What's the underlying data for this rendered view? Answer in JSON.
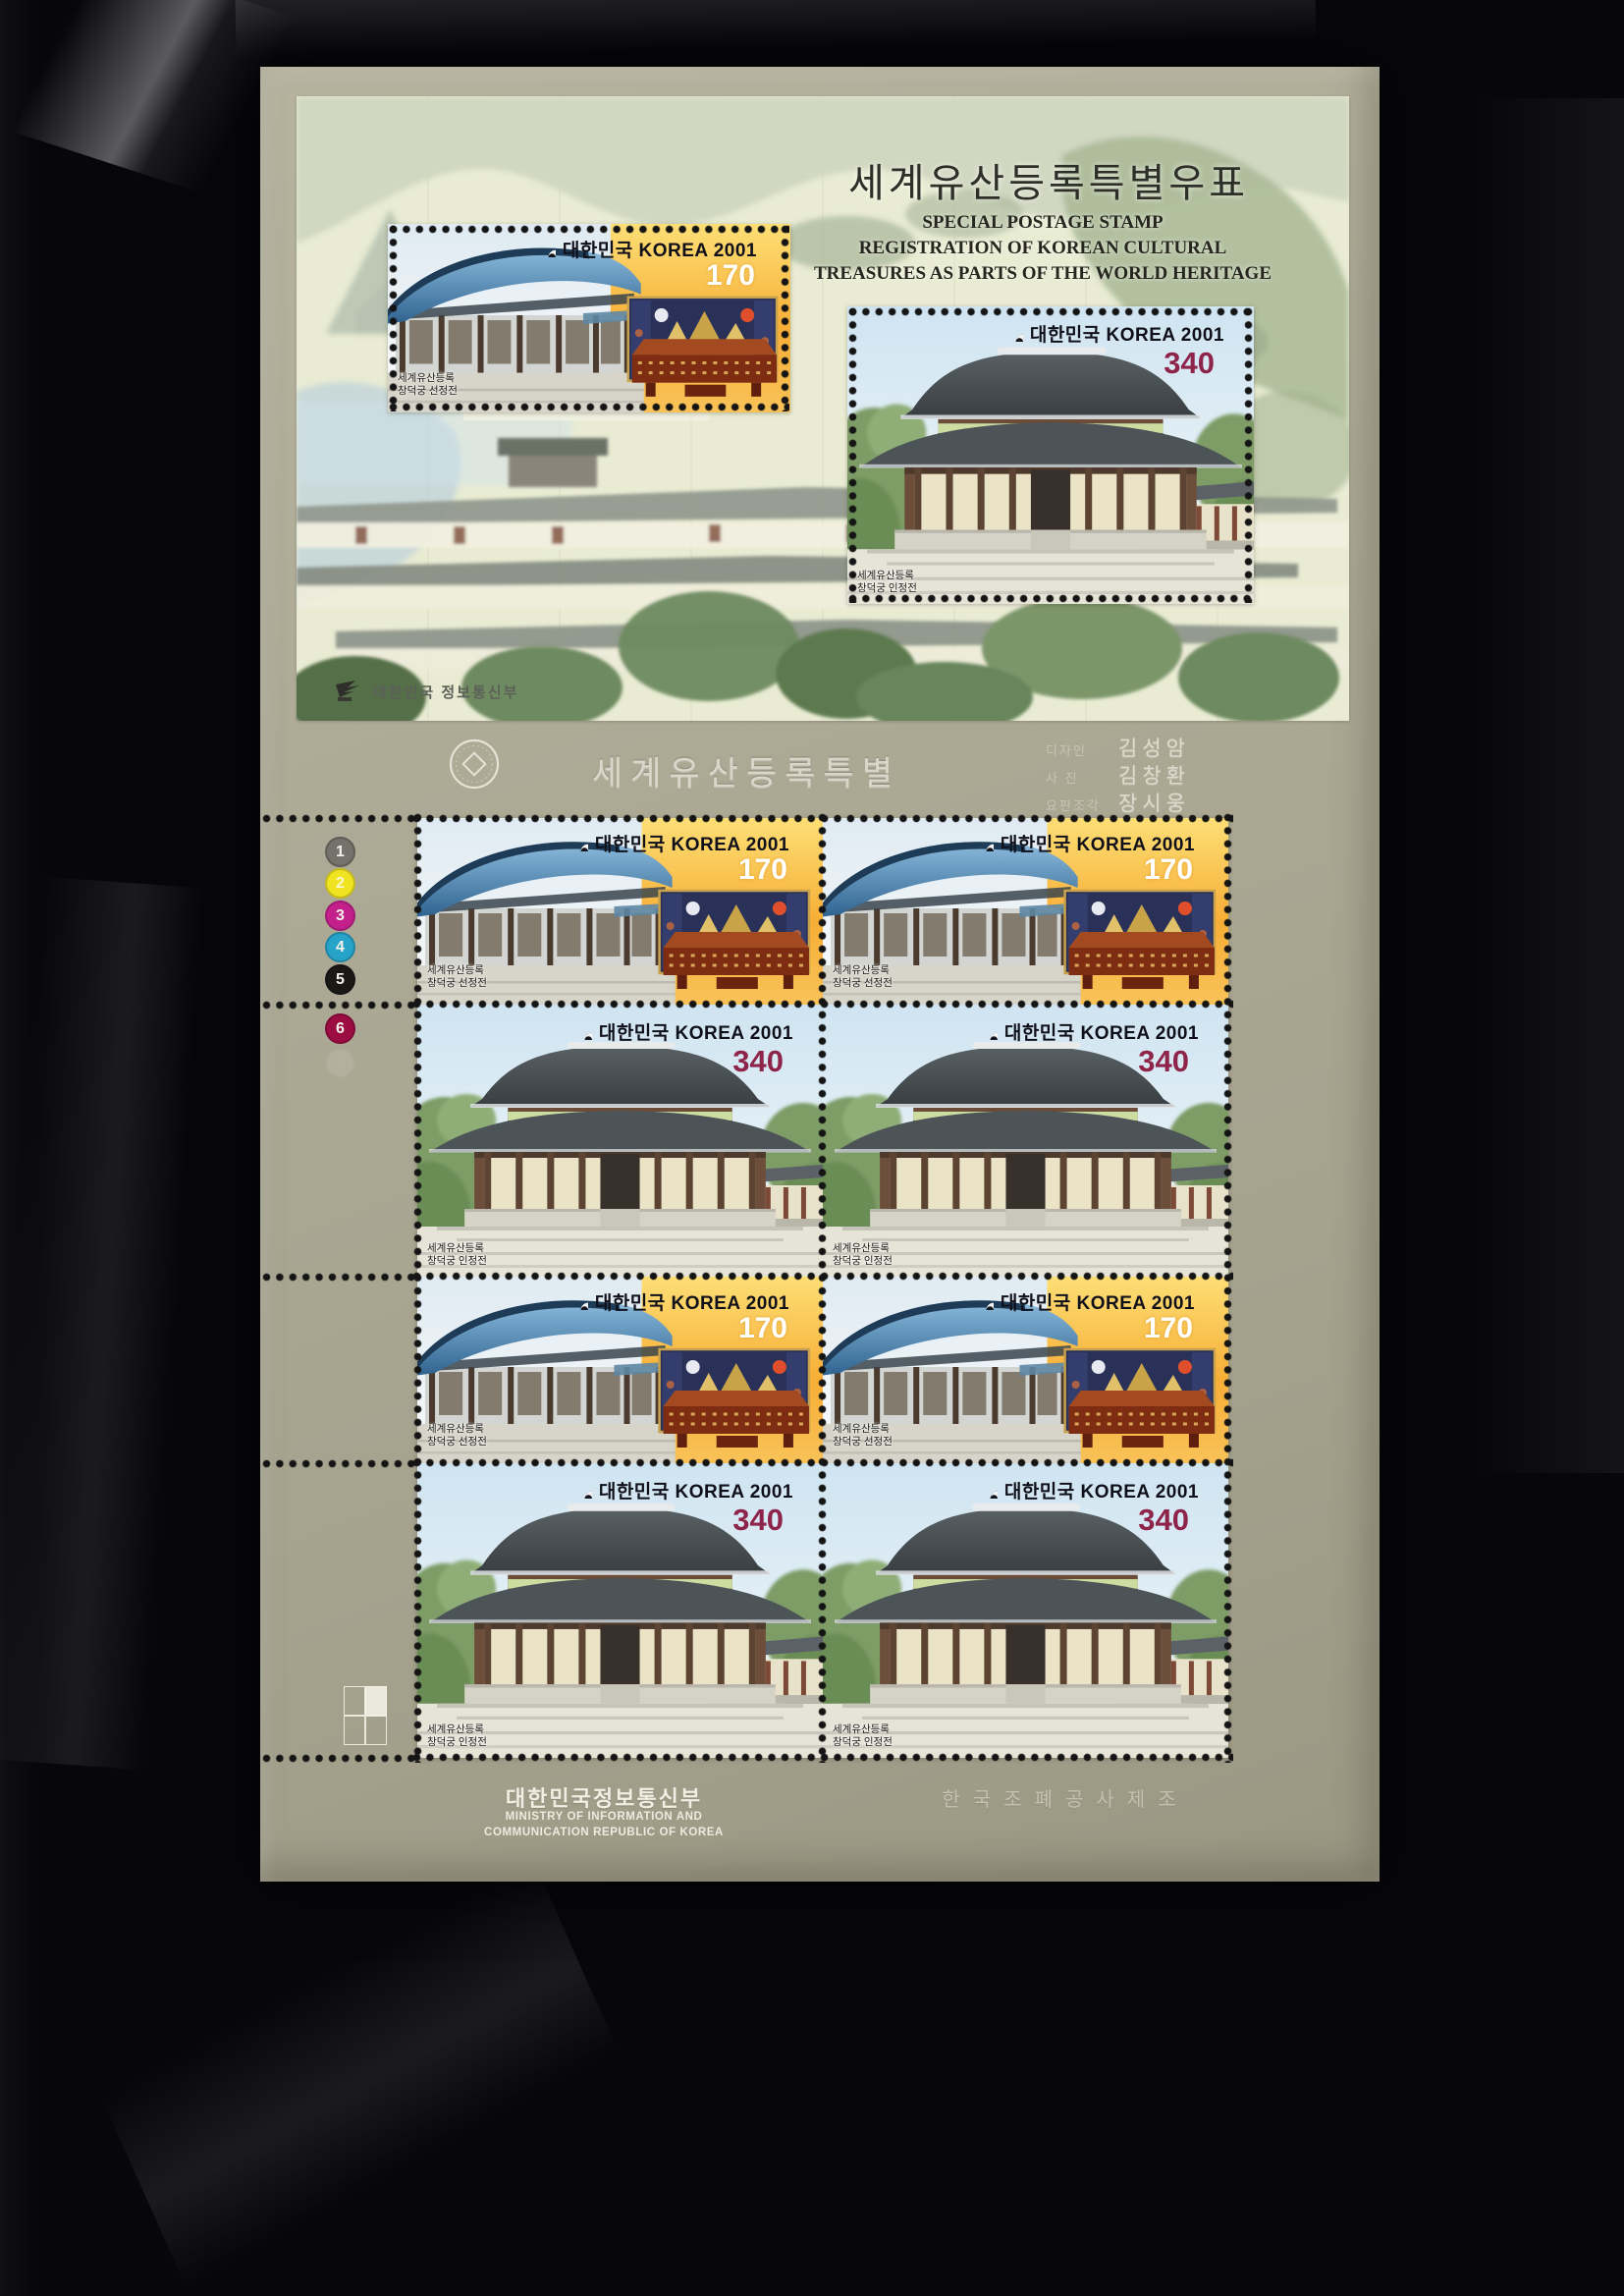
{
  "artwork": {
    "title_ko": "세계유산등록특별우표",
    "subtitle1": "SPECIAL POSTAGE STAMP",
    "subtitle2": "REGISTRATION OF  KOREAN  CULTURAL",
    "subtitle3": "TREASURES AS PARTS OF THE WORLD HERITAGE",
    "panel_credit": "대한민국 정보통신부"
  },
  "header_band": {
    "title": "세계유산등록특별",
    "credits": [
      {
        "label": "디자인",
        "name": "김성암"
      },
      {
        "label": "사 진",
        "name": "김창환"
      },
      {
        "label": "요판조각",
        "name": "장시웅"
      }
    ]
  },
  "stamps": {
    "s170": {
      "country": "대한민국 KOREA 2001",
      "value": "170",
      "caption1": "세계유산등록",
      "caption2": "창덕궁 선정전",
      "value_color": "#ffffff",
      "accent_color": "#f6a62f"
    },
    "s340": {
      "country": "대한민국 KOREA 2001",
      "value": "340",
      "caption1": "세계유산등록",
      "caption2": "창덕궁 인정전",
      "value_color": "#8e2449"
    }
  },
  "color_dots": [
    {
      "n": "1",
      "color": "#74726a"
    },
    {
      "n": "2",
      "color": "#f0e322"
    },
    {
      "n": "3",
      "color": "#c3208c"
    },
    {
      "n": "4",
      "color": "#27a3c9"
    },
    {
      "n": "5",
      "color": "#1a1918"
    },
    {
      "n": "6",
      "color": "#9c0d42"
    },
    {
      "n": "7",
      "color": "#b3b09d"
    }
  ],
  "footer": {
    "ministry_ko": "대한민국정보통신부",
    "ministry_en1": "MINISTRY OF  INFORMATION AND",
    "ministry_en2": "COMMUNICATION  REPUBLIC OF KOREA",
    "printer": "한국조폐공사제조"
  }
}
